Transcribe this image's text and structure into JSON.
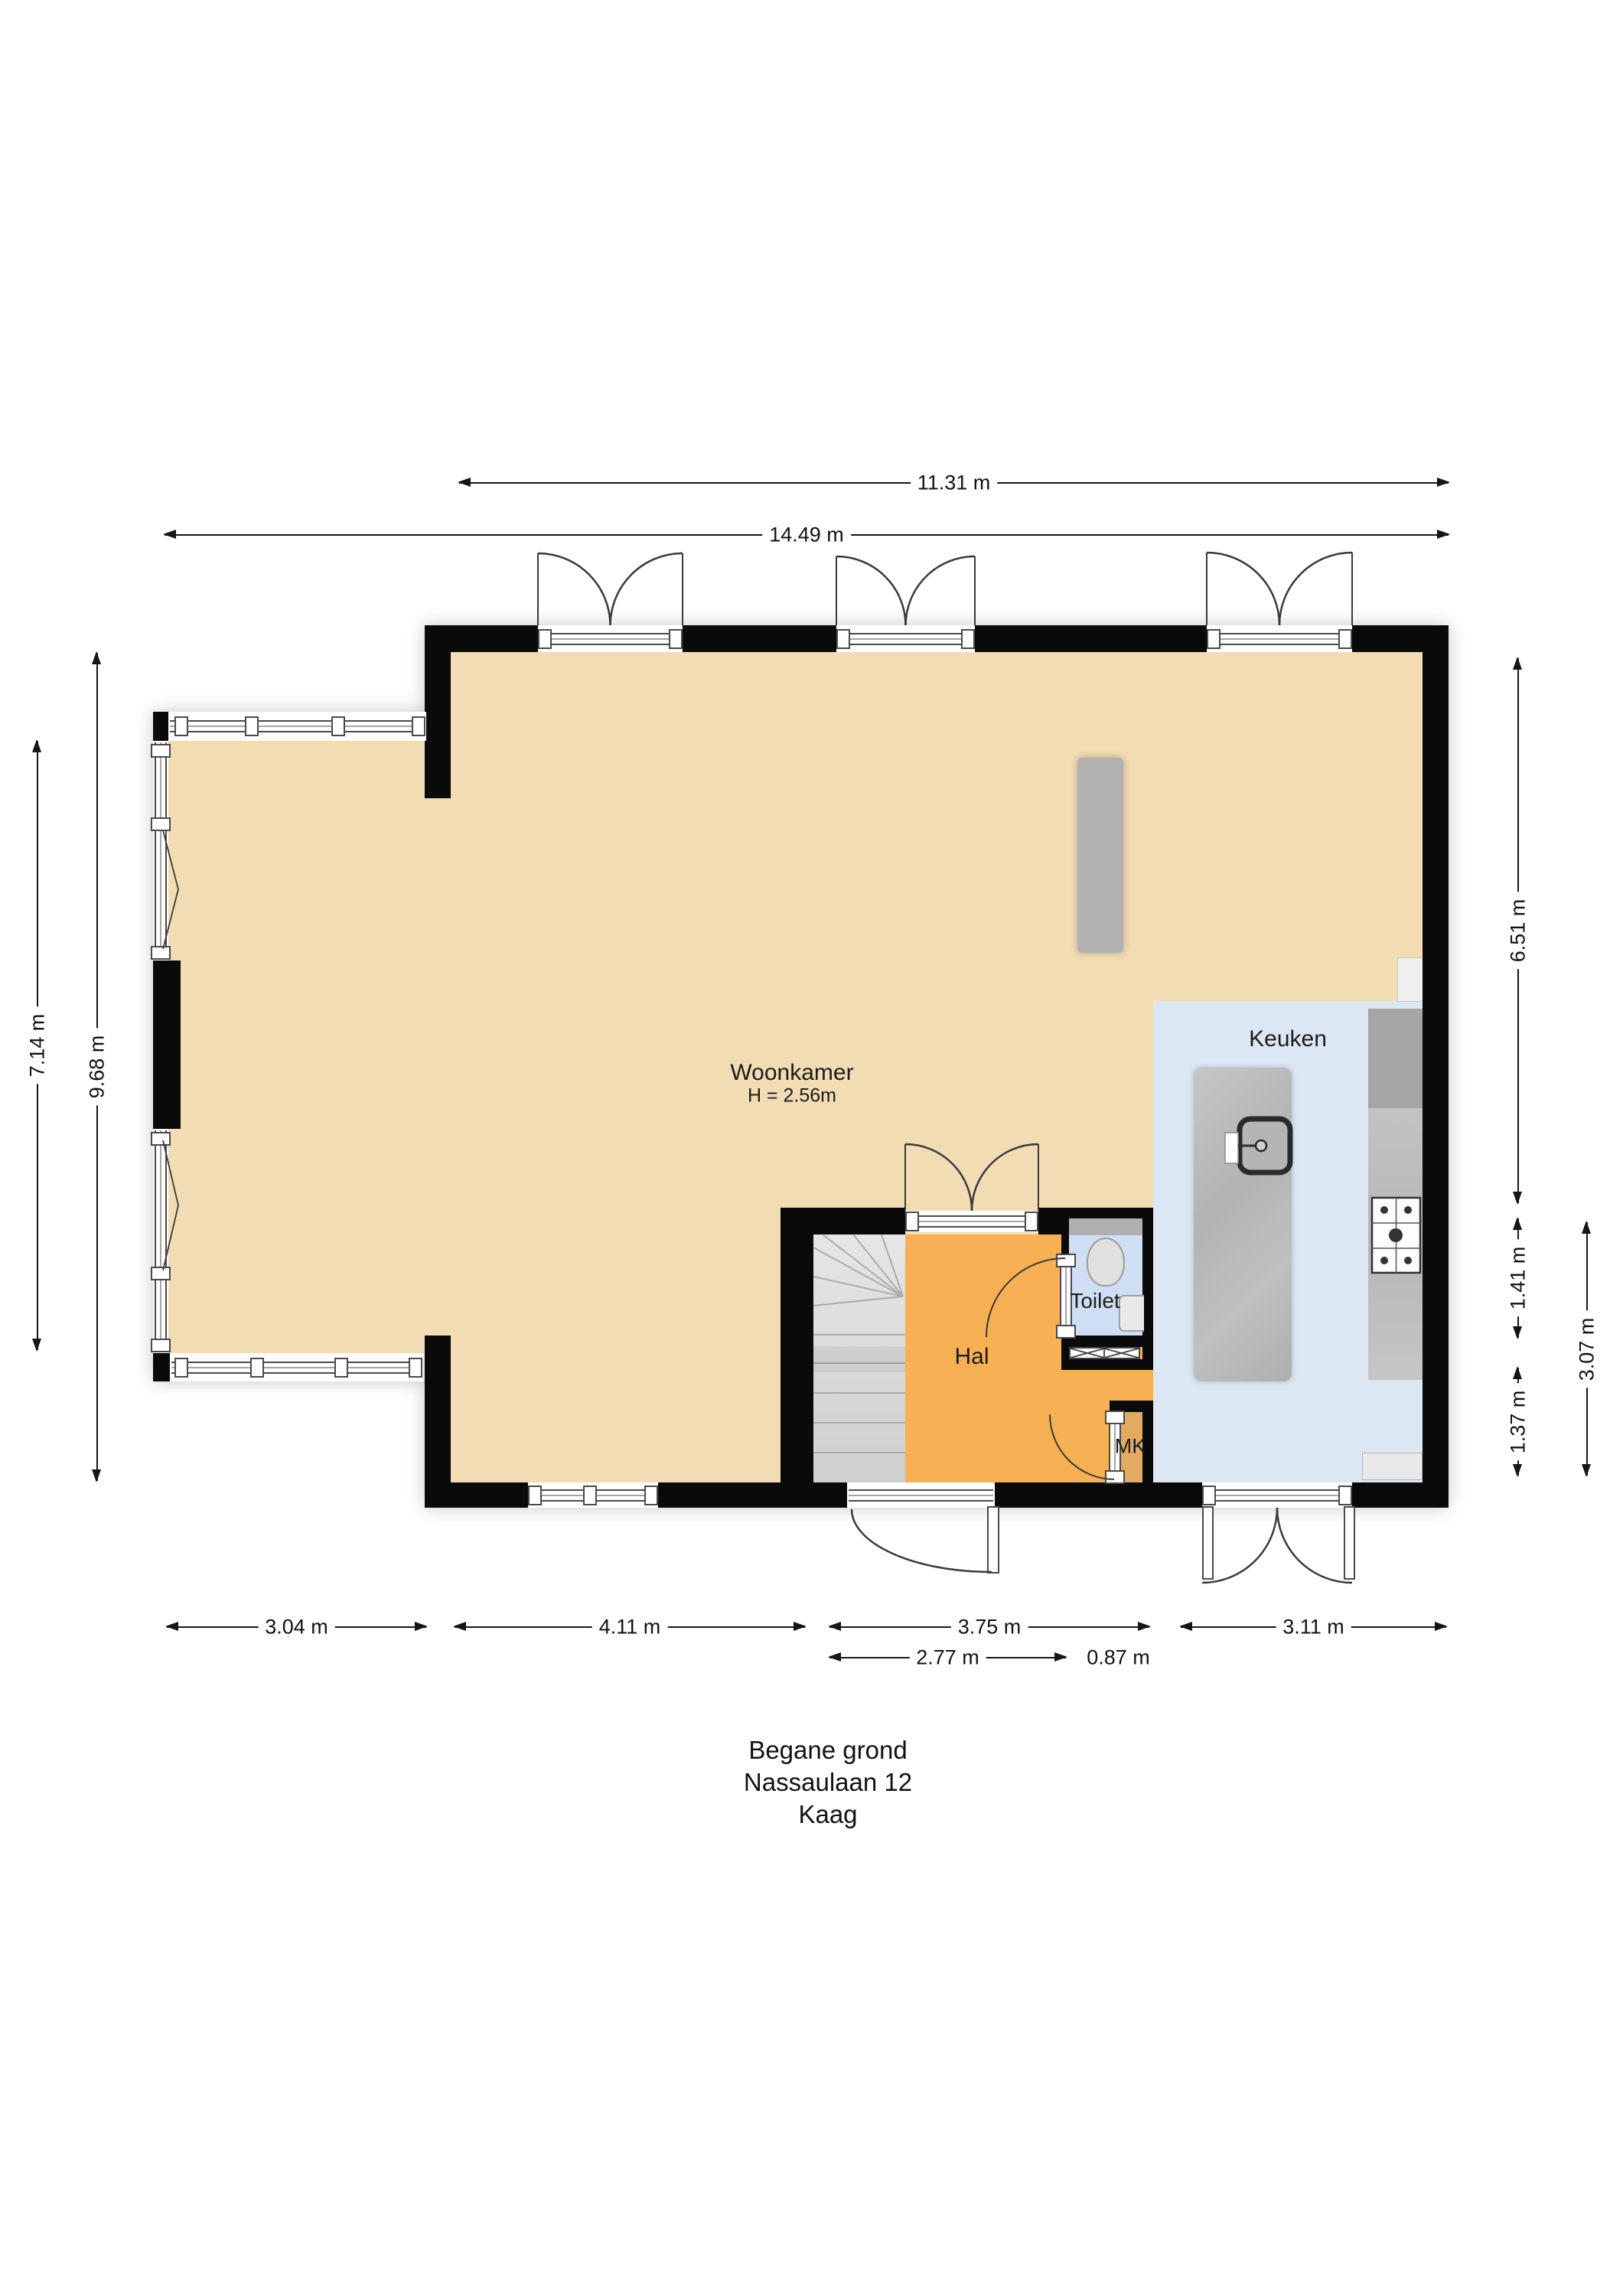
{
  "title": {
    "line1": "Begane grond",
    "line2": "Nassaulaan 12",
    "line3": "Kaag"
  },
  "rooms": {
    "woonkamer": {
      "name": "Woonkamer",
      "height_label": "H = 2.56m"
    },
    "keuken": {
      "name": "Keuken"
    },
    "hal": {
      "name": "Hal"
    },
    "toilet": {
      "name": "Toilet"
    },
    "mk": {
      "name": "MK"
    }
  },
  "dimensions": {
    "top_inner": "11.31 m",
    "top_outer": "14.49 m",
    "left_inner": "7.14 m",
    "left_outer": "9.68 m",
    "right_top": "6.51 m",
    "right_mid": "1.41 m",
    "right_low": "1.37 m",
    "right_outer": "3.07 m",
    "bottom": [
      "3.04 m",
      "4.11 m",
      "3.75 m",
      "3.11 m"
    ],
    "bottom_sub": [
      "2.77 m",
      "0.87 m"
    ]
  },
  "colors": {
    "wall": "#0a0a0a",
    "woonkamer_floor": "#f2dcb4",
    "hal_floor": "#f7b052",
    "mk_floor": "#e3aa61",
    "toilet_floor": "#cfdef2",
    "keuken_floor": "#dce7f4",
    "stairs": "#d9d9d9",
    "counter": "#bcbcbc",
    "dimension_text": "#111111"
  }
}
